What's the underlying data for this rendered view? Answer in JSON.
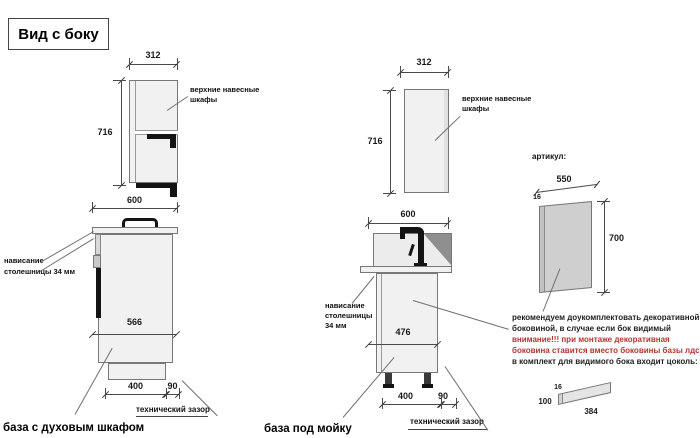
{
  "title": "Вид с боку",
  "colors": {
    "attention_red": "#b5342e",
    "drawing_line": "#4a4a4a",
    "cabinet_fill": "#f1f1f1",
    "panel_fill": "#cfcfcf",
    "black_parts": "#141414"
  },
  "upper_left": {
    "width": "312",
    "height": "716",
    "label_line1": "верхние навесные",
    "label_line2": "шкафы"
  },
  "base_left": {
    "top_width": "600",
    "depth": "566",
    "plinth_depth": "400",
    "gap": "90",
    "overhang_line1": "нависание",
    "overhang_line2": "столешницы 34 мм",
    "gap_label": "технический зазор",
    "caption": "база с духовым шкафом"
  },
  "upper_mid": {
    "width": "312",
    "height": "716",
    "label_line1": "верхние навесные",
    "label_line2": "шкафы"
  },
  "base_mid": {
    "top_width": "600",
    "depth": "476",
    "plinth_depth": "400",
    "gap": "90",
    "overhang_line1": "нависание",
    "overhang_line2": "столешницы",
    "overhang_line3": "34 мм",
    "gap_label": "технический зазор",
    "caption": "база под мойку"
  },
  "side_panel": {
    "header": "артикул:",
    "width": "550",
    "thickness": "16",
    "height": "700"
  },
  "note": {
    "line1": "рекомендуем доукомплектовать декоративной",
    "line2": "боковиной, в случае если бок видимый",
    "line3": "внимание!!! при монтаже декоративная",
    "line4": "боковина ставится вместо боковины базы лдсп",
    "line5": "в комплект для видимого бока входит цоколь:"
  },
  "plinth": {
    "thickness": "16",
    "height": "100",
    "length": "384"
  }
}
